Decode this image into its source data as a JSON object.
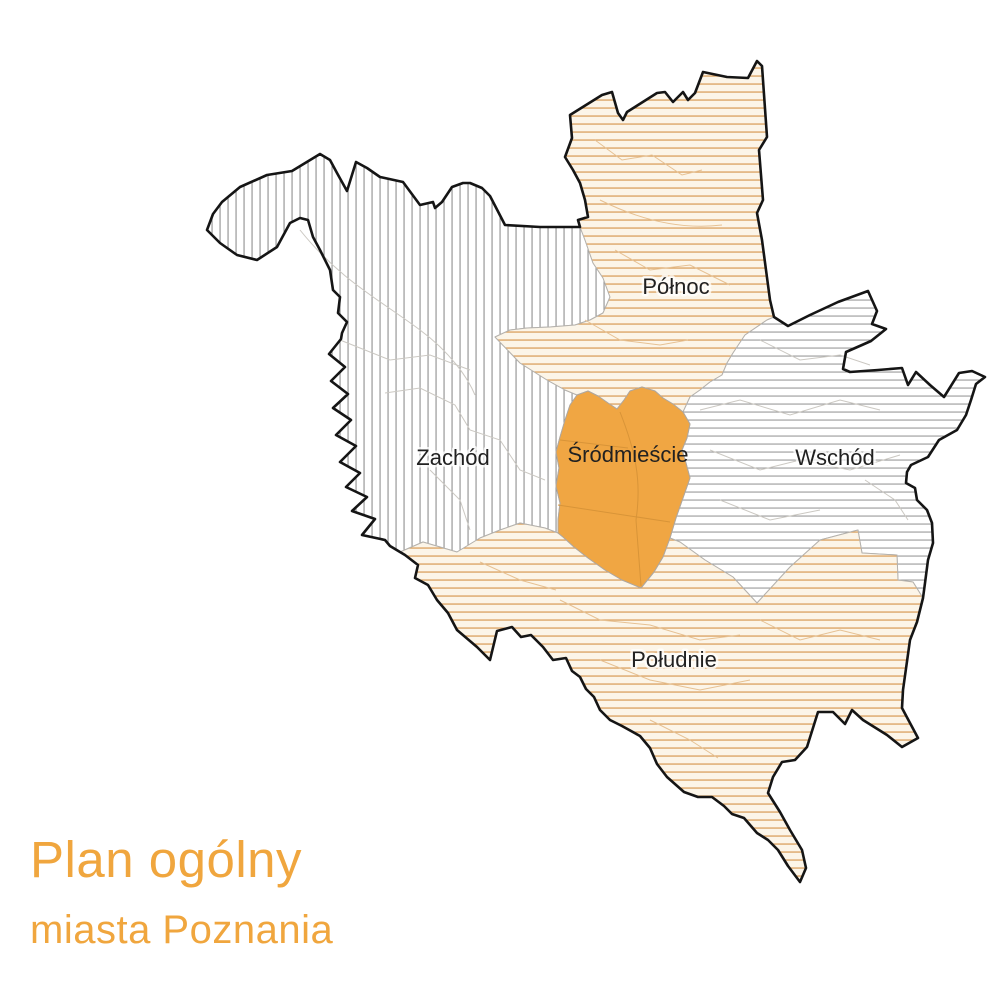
{
  "title": {
    "line1": "Plan ogólny",
    "line2": "miasta Poznania"
  },
  "map": {
    "name": "Plan ogólny miasta Poznania — mapa stref",
    "districts": [
      {
        "id": "polnoc",
        "label": "Północ",
        "fill_style": "orange-horizontal-hatch"
      },
      {
        "id": "zachod",
        "label": "Zachód",
        "fill_style": "gray-vertical-hatch"
      },
      {
        "id": "srodmiescie",
        "label": "Śródmieście",
        "fill_style": "solid-orange"
      },
      {
        "id": "wschod",
        "label": "Wschód",
        "fill_style": "gray-horizontal-hatch"
      },
      {
        "id": "poludnie",
        "label": "Południe",
        "fill_style": "orange-horizontal-hatch"
      }
    ],
    "colors": {
      "orange_fill": "#F0A643",
      "orange_hatch_line": "#DBA15F",
      "hatch_background_cream": "#FCF5E8",
      "gray_hatch_line": "#8F8F8F",
      "city_outline": "#151515",
      "subboundary_gray": "#CBC8C2",
      "subboundary_orange": "#E6C193",
      "label_text": "#212121",
      "title_text": "#F0A63E"
    }
  }
}
